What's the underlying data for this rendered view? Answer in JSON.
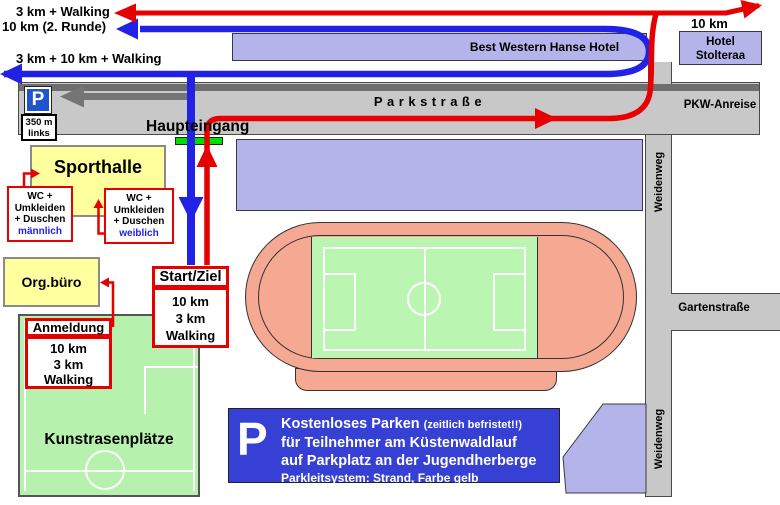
{
  "colors": {
    "route_red": "#e60000",
    "route_blue": "#2222e6",
    "road_gray": "#c8c8c8",
    "building_purple": "#b4b4ea",
    "field_green": "#b6f2ae",
    "track_salmon": "#f5a892",
    "highlight_yellow": "#ffff9e",
    "info_blue": "#3640d4",
    "entrance_green": "#00dd00"
  },
  "route_labels": {
    "red_return": "3 km + Walking",
    "blue_second_lap": "10 km (2. Runde)",
    "blue_outbound": "3 km + 10 km + Walking",
    "red_outbound": "10 km"
  },
  "roads": {
    "parkstrasse": "Parkstraße",
    "pkw_anreise": "PKW-Anreise",
    "weidenweg_north": "Weidenweg",
    "weidenweg_south": "Weidenweg",
    "gartenstrasse": "Gartenstraße"
  },
  "hotels": {
    "best_western": "Best Western Hanse Hotel",
    "stolteraa_line1": "Hotel",
    "stolteraa_line2": "Stolteraa"
  },
  "venue": {
    "sporthalle": "Sporthalle",
    "org_office": "Org.büro",
    "main_entrance": "Haupteingang",
    "artificial_turf": "Kunstrasenplätze"
  },
  "parking_sign": {
    "symbol": "P",
    "distance": "350 m",
    "direction": "links"
  },
  "wc_male": {
    "line1": "WC +",
    "line2": "Umkleiden",
    "line3": "+ Duschen",
    "gender": "männlich"
  },
  "wc_female": {
    "line1": "WC +",
    "line2": "Umkleiden",
    "line3": "+ Duschen",
    "gender": "weiblich"
  },
  "start_finish": {
    "title": "Start/Ziel",
    "items": [
      "10 km",
      "3 km",
      "Walking"
    ]
  },
  "registration": {
    "title": "Anmeldung",
    "items": [
      "10 km",
      "3 km",
      "Walking"
    ]
  },
  "info_box": {
    "symbol": "P",
    "headline": "Kostenloses Parken",
    "headline_note": "(zeitlich befristet!!)",
    "line2": "für Teilnehmer am Küstenwaldlauf",
    "line3": "auf Parkplatz an der Jugendherberge",
    "line4": "Parkleitsystem: Strand, Farbe gelb"
  }
}
